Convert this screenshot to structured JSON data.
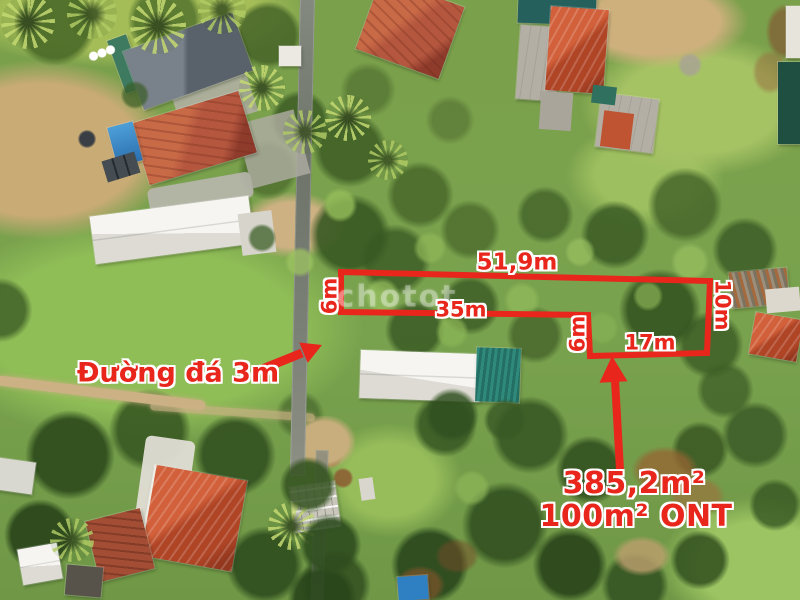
{
  "annotations": {
    "accent_color": "#e8261c",
    "plot": {
      "top_length": "51,9m",
      "left_width": "6m",
      "inner_length": "35m",
      "inner_width": "6m",
      "bottom_length": "17m",
      "right_width": "10m"
    },
    "road_label": "Đường đá 3m",
    "area_total": "385,2m²",
    "area_residential": "100m² ONT",
    "watermark": "chotot"
  }
}
